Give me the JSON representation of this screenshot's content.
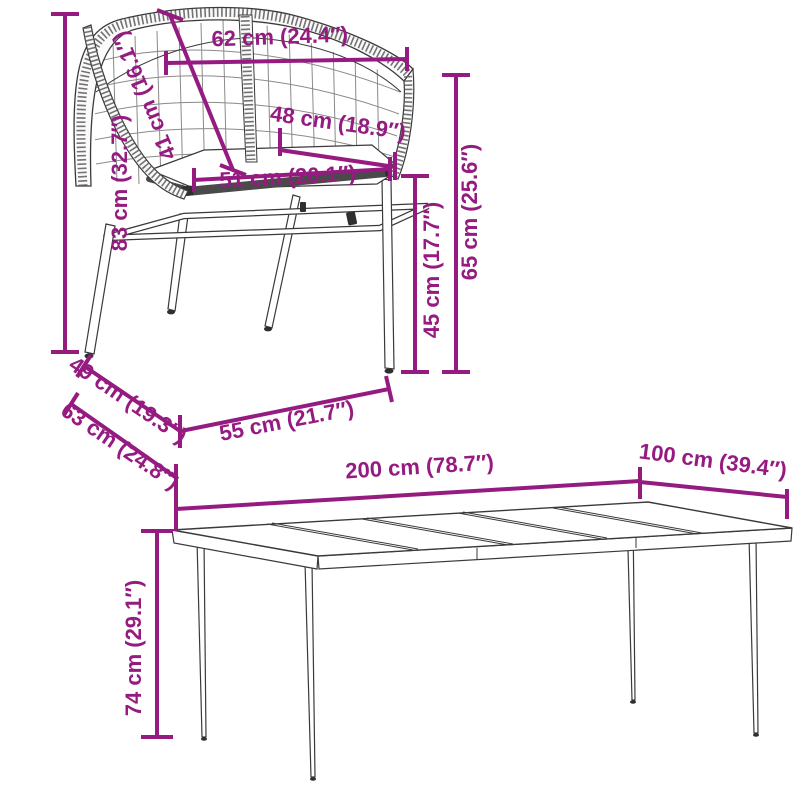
{
  "colors": {
    "accent": "#951B81",
    "line": "#3a3a3a"
  },
  "items": {
    "chair": {
      "name": "wicker dining chair",
      "dims": {
        "back_width": "62 cm (24.4″)",
        "backrest_height": "41 cm (16.1″)",
        "total_height": "83 cm (32.7″)",
        "inner_width": "48 cm (18.9″)",
        "seat_width": "51 cm (20.1″)",
        "armrest_height": "65 cm (25.6″)",
        "seat_height": "45 cm (17.7″)",
        "seat_depth": "49 cm (19.3″)",
        "total_depth": "63 cm (24.8″)",
        "base_width": "55 cm (21.7″)"
      }
    },
    "table": {
      "name": "garden dining table",
      "dims": {
        "length": "200 cm (78.7″)",
        "width": "100 cm (39.4″)",
        "height": "74 cm (29.1″)"
      }
    }
  }
}
